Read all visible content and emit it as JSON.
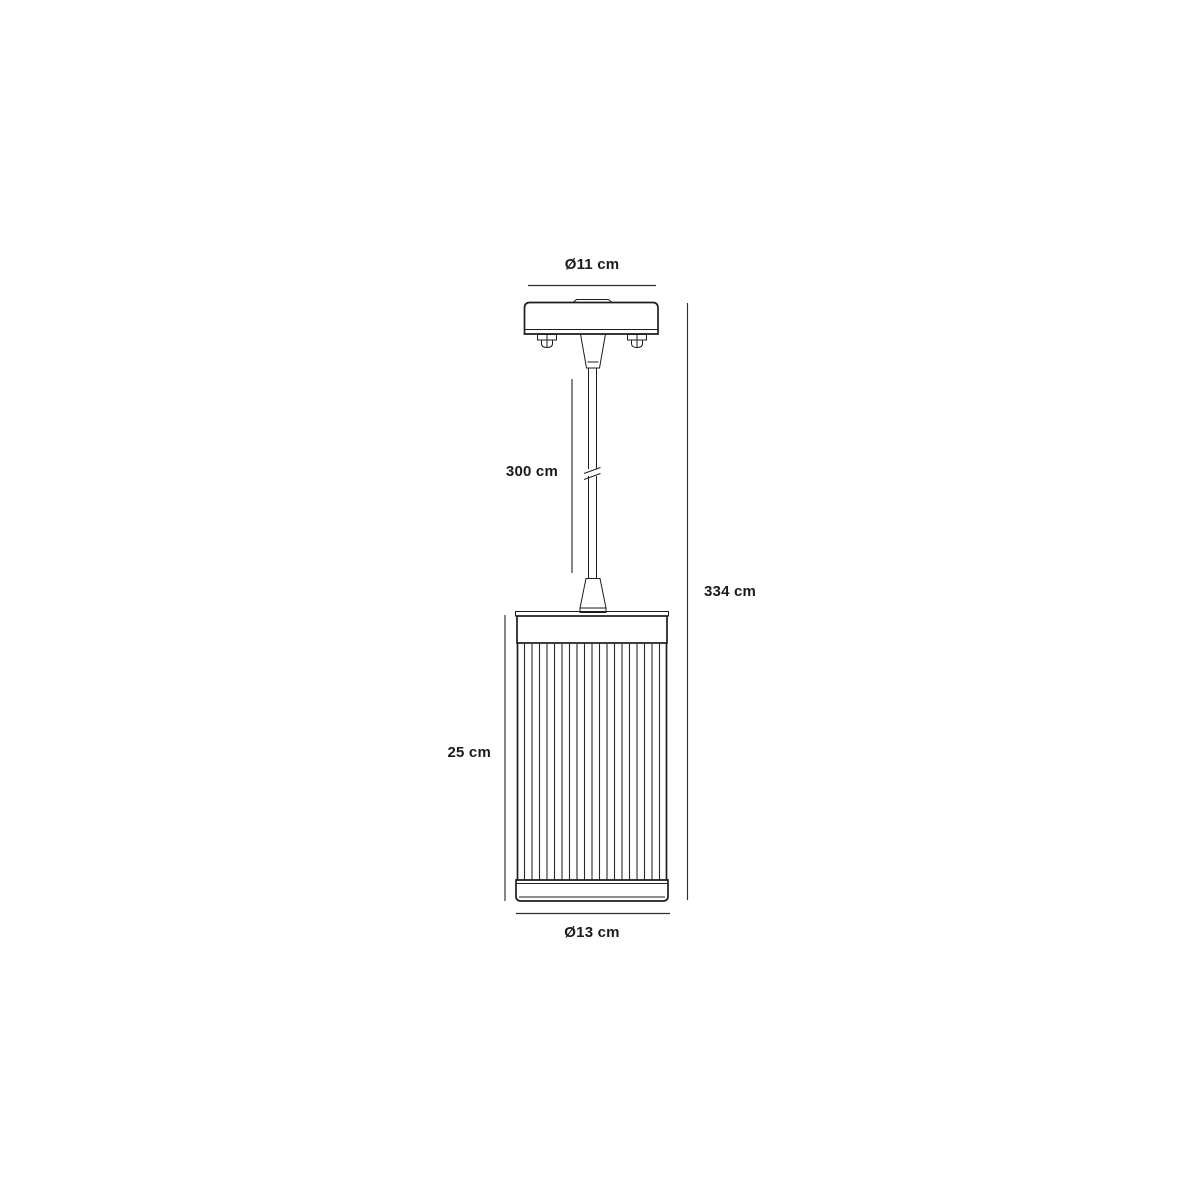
{
  "page": {
    "background": "#ffffff",
    "line_color": "#1d1d1d",
    "dimension_line_color": "#2e2e2e",
    "text_color": "#1b1b1b"
  },
  "drawing": {
    "type": "technical-dimension-diagram",
    "subject": "pendant lamp with ceiling canopy, suspension cord and ribbed cylindrical shade",
    "dimensions": {
      "canopy_diameter": "Ø11 cm",
      "cord_length": "300 cm",
      "total_height": "334 cm",
      "shade_height": "25 cm",
      "shade_diameter": "Ø13 cm"
    }
  }
}
